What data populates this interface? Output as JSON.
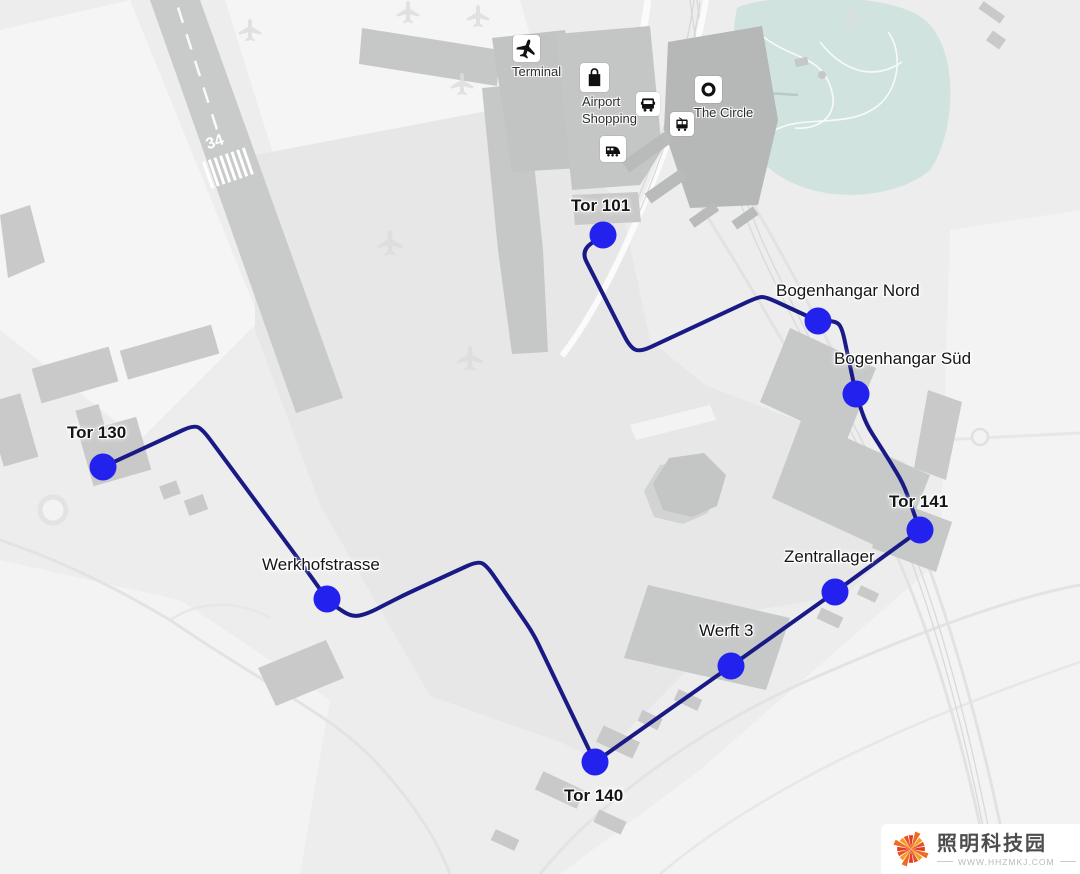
{
  "colors": {
    "background": "#ecedec",
    "light_patch": "#f4f5f4",
    "apron": "#e6e7e6",
    "building": "#c8c9c8",
    "building_dark": "#b6b7b7",
    "park": "#d0e3df",
    "road": "#e4e4e4",
    "route_line": "#191a86",
    "marker": "#2321ee",
    "runway": "#c9caca",
    "label_text": "#151515"
  },
  "runway": {
    "number": "34"
  },
  "route": {
    "stroke_width": 4,
    "marker_radius": 13.5,
    "points": [
      [
        603,
        235
      ],
      [
        581,
        251
      ],
      [
        630,
        347
      ],
      [
        640,
        352
      ],
      [
        758,
        297
      ],
      [
        766,
        297
      ],
      [
        818,
        321
      ],
      [
        836,
        321
      ],
      [
        842,
        328
      ],
      [
        856,
        394
      ],
      [
        866,
        424
      ],
      [
        884,
        452
      ],
      [
        903,
        483
      ],
      [
        920,
        530
      ],
      [
        835,
        592
      ],
      [
        731,
        666
      ],
      [
        595,
        762
      ],
      [
        533,
        633
      ],
      [
        487,
        566
      ],
      [
        478,
        561
      ],
      [
        404,
        595
      ],
      [
        367,
        614
      ],
      [
        352,
        617
      ],
      [
        336,
        607
      ],
      [
        327,
        599
      ],
      [
        297,
        557
      ],
      [
        203,
        430
      ],
      [
        194,
        425
      ],
      [
        103,
        467
      ]
    ],
    "stops": [
      {
        "id": "tor-101",
        "label": "Tor 101",
        "bold": true,
        "x": 603,
        "y": 235,
        "label_x": 571,
        "label_y": 196
      },
      {
        "id": "bogenhangar-nord",
        "label": "Bogenhangar Nord",
        "bold": false,
        "x": 818,
        "y": 321,
        "label_x": 776,
        "label_y": 281
      },
      {
        "id": "bogenhangar-sued",
        "label": "Bogenhangar Süd",
        "bold": false,
        "x": 856,
        "y": 394,
        "label_x": 834,
        "label_y": 349
      },
      {
        "id": "tor-141",
        "label": "Tor 141",
        "bold": true,
        "x": 920,
        "y": 530,
        "label_x": 889,
        "label_y": 492
      },
      {
        "id": "zentrallager",
        "label": "Zentrallager",
        "bold": false,
        "x": 835,
        "y": 592,
        "label_x": 784,
        "label_y": 547
      },
      {
        "id": "werft-3",
        "label": "Werft 3",
        "bold": false,
        "x": 731,
        "y": 666,
        "label_x": 699,
        "label_y": 621
      },
      {
        "id": "tor-140",
        "label": "Tor 140",
        "bold": true,
        "x": 595,
        "y": 762,
        "label_x": 564,
        "label_y": 786
      },
      {
        "id": "werkhofstrasse",
        "label": "Werkhofstrasse",
        "bold": false,
        "x": 327,
        "y": 599,
        "label_x": 262,
        "label_y": 555
      },
      {
        "id": "tor-130",
        "label": "Tor 130",
        "bold": true,
        "x": 103,
        "y": 467,
        "label_x": 67,
        "label_y": 423
      }
    ]
  },
  "pois": [
    {
      "id": "terminal",
      "label": "Terminal",
      "icon": "airplane-icon",
      "x": 513,
      "y": 35,
      "size": 27,
      "label_x": 512,
      "label_y": 63
    },
    {
      "id": "airport-shopping",
      "label": "Airport\nShopping",
      "icon": "shopping-bag-icon",
      "x": 580,
      "y": 63,
      "size": 29,
      "label_x": 582,
      "label_y": 93
    },
    {
      "id": "bus-stop",
      "label": "",
      "icon": "bus-icon",
      "x": 636,
      "y": 92,
      "size": 24,
      "label_x": 0,
      "label_y": 0
    },
    {
      "id": "tram-stop",
      "label": "",
      "icon": "tram-icon",
      "x": 670,
      "y": 112,
      "size": 24,
      "label_x": 0,
      "label_y": 0
    },
    {
      "id": "train-station",
      "label": "",
      "icon": "train-icon",
      "x": 600,
      "y": 136,
      "size": 26,
      "label_x": 0,
      "label_y": 0
    },
    {
      "id": "the-circle",
      "label": "The Circle",
      "icon": "circle-ring-icon",
      "x": 695,
      "y": 76,
      "size": 27,
      "label_x": 694,
      "label_y": 104
    }
  ],
  "watermark": {
    "title": "照明科技园",
    "url": "WWW.HHZMKJ.COM"
  }
}
